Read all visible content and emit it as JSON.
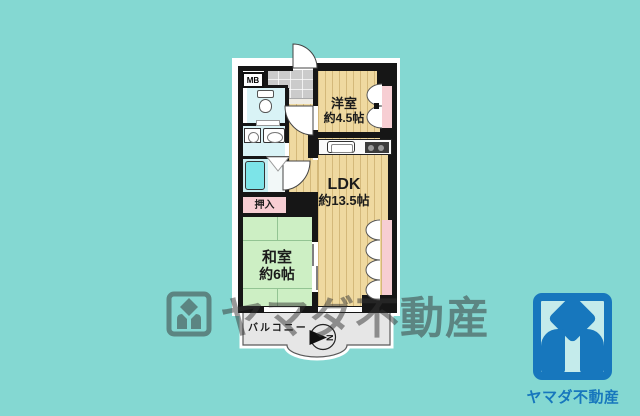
{
  "page": {
    "background_color": "#84D8D2"
  },
  "plan": {
    "rooms": {
      "western_room": {
        "label": "洋室",
        "size": "約4.5帖"
      },
      "ldk": {
        "label": "LDK",
        "size": "約13.5帖"
      },
      "japanese_room": {
        "label": "和室",
        "size": "約6帖"
      },
      "closet": {
        "label": "押入"
      },
      "balcony": {
        "label": "バルコニー"
      },
      "meter_box": {
        "label": "MB"
      }
    },
    "compass": {
      "north_label": "N"
    },
    "colors": {
      "wall": "#161616",
      "wood_floor": "#EFD9A0",
      "tatami_green": "#CDEFC4",
      "closet_pink": "#F7CED3",
      "wet_area_blue": "#D9F3F6",
      "bath_blue": "#C8EFF3",
      "balcony_gray": "#E6E6E6"
    }
  },
  "watermark": {
    "text": "ヤマダ不動産"
  },
  "logo": {
    "company_name": "ヤマダ不動産",
    "brand_color": "#1777BD"
  }
}
